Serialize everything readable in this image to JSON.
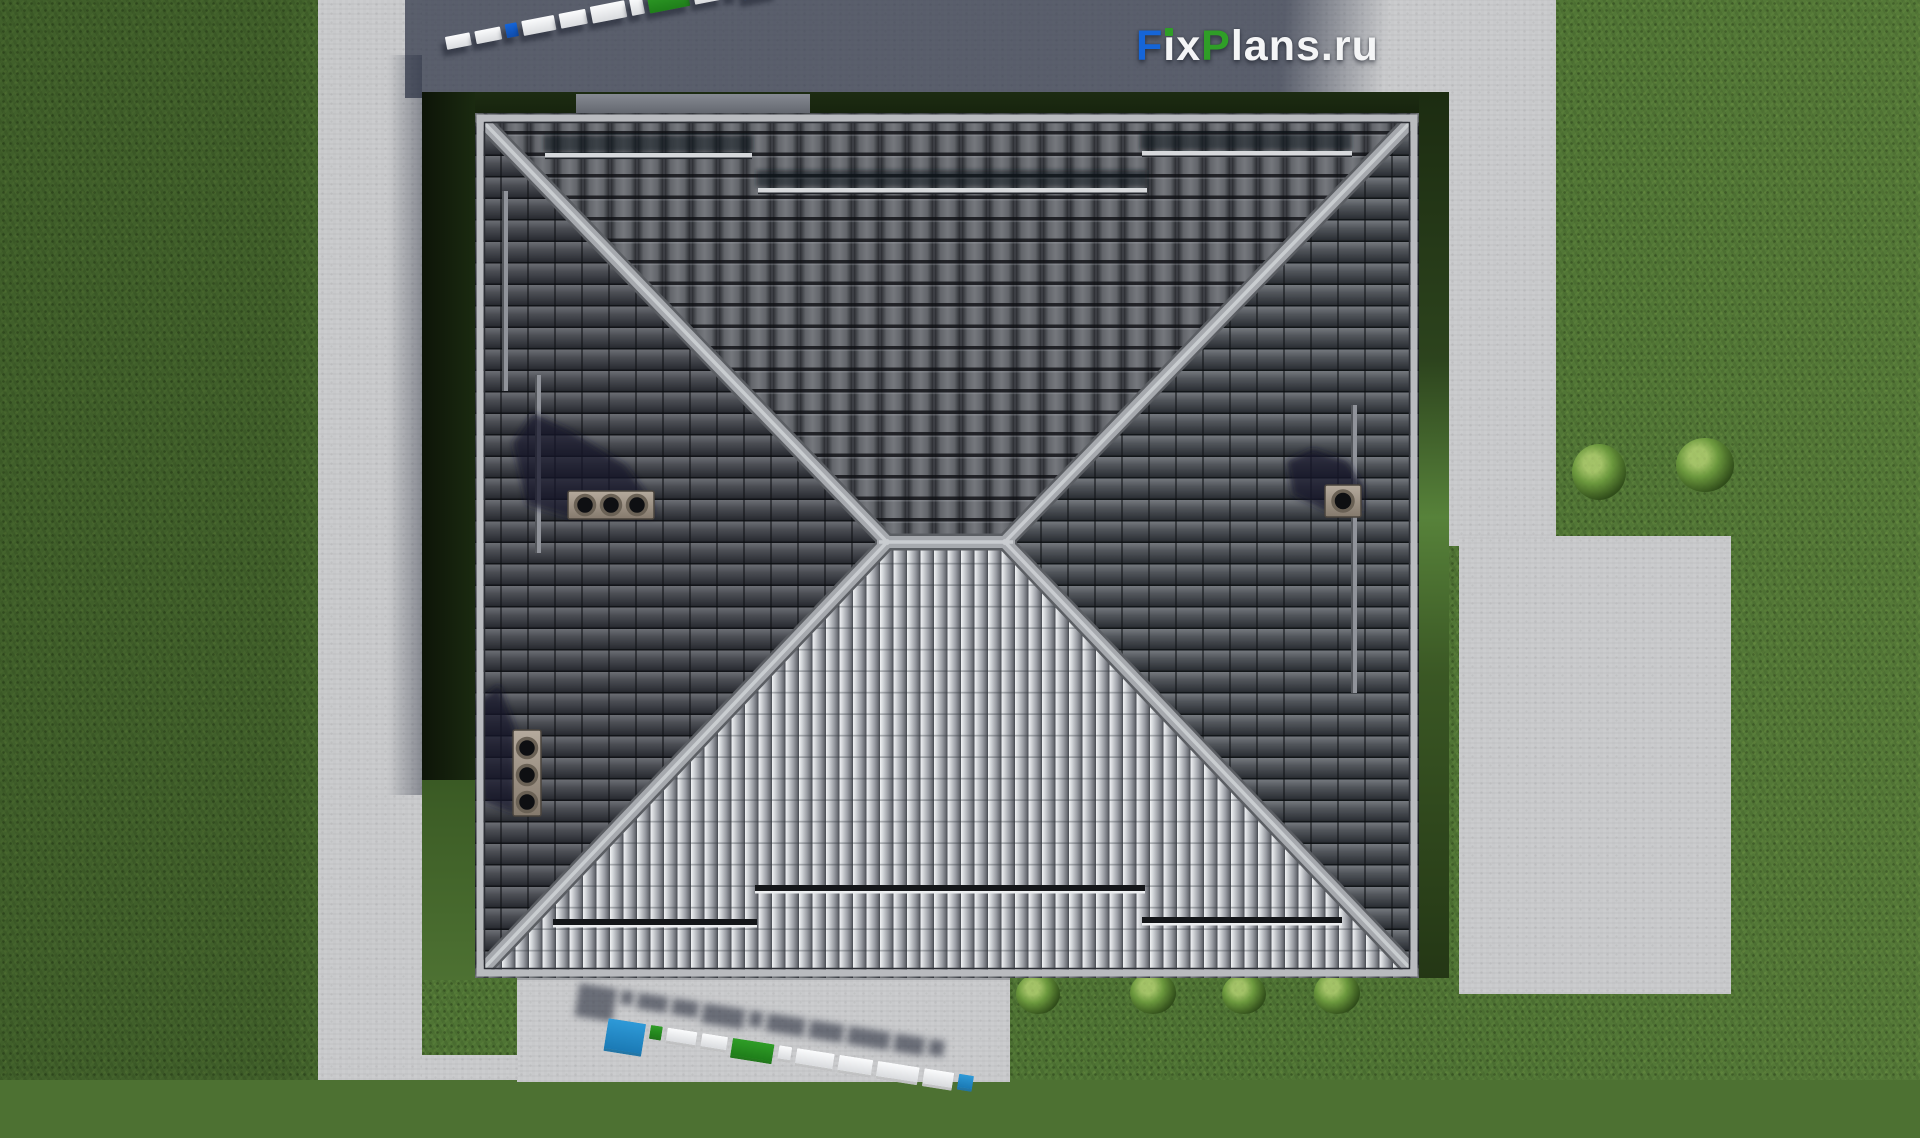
{
  "brand": {
    "logo_text": "FixPlans.ru",
    "logo_segments": {
      "f": "F",
      "ix": "ix",
      "p": "P",
      "rest": "lans.ru"
    },
    "colors": {
      "blue": "#1565d8",
      "green": "#2f9e27",
      "white": "#f4f5f6",
      "sky": "#2e9ad8"
    }
  },
  "scene": {
    "type": "top-down 3d render of hipped roof house",
    "roof": {
      "tile_dark": "#55585f",
      "tile_bright": "#c3c5ca",
      "ridge": "#a6a9ae",
      "eave_trim": "#b9bbbf",
      "chimney_cap": "#a99d90",
      "chimney_count": 3,
      "snow_guard_count_top": 3,
      "snow_guard_count_bottom": 3
    },
    "ground": {
      "grass": "#4f7434",
      "concrete": "#c8c9cb",
      "driveway_in_shadow": "#5a6070",
      "hedge": "#1d2c12",
      "bush_count_right_lawn": 2,
      "bush_count_south_bed": 4
    }
  },
  "watermark_top": {
    "rotation_deg": -11,
    "blocks": [
      {
        "c": "white",
        "w": 30,
        "h": 13
      },
      {
        "c": "white",
        "w": 32,
        "h": 13
      },
      {
        "c": "blue",
        "w": 15,
        "h": 14
      },
      {
        "c": "white",
        "w": 40,
        "h": 15
      },
      {
        "c": "white",
        "w": 33,
        "h": 15
      },
      {
        "c": "white",
        "w": 44,
        "h": 17
      },
      {
        "c": "white",
        "w": 15,
        "h": 17
      },
      {
        "c": "green",
        "w": 50,
        "h": 20
      },
      {
        "c": "white",
        "w": 35,
        "h": 20
      },
      {
        "c": "green",
        "w": 13,
        "h": 20
      },
      {
        "c": "blue",
        "w": 42,
        "h": 30
      }
    ]
  },
  "watermark_bottom": {
    "rotation_deg": 9,
    "blocks": [
      {
        "c": "sky",
        "w": 38,
        "h": 30
      },
      {
        "c": "green",
        "w": 12,
        "h": 11
      },
      {
        "c": "white",
        "w": 30,
        "h": 13
      },
      {
        "c": "white",
        "w": 26,
        "h": 13
      },
      {
        "c": "green",
        "w": 42,
        "h": 17
      },
      {
        "c": "white",
        "w": 13,
        "h": 13
      },
      {
        "c": "white",
        "w": 38,
        "h": 15
      },
      {
        "c": "white",
        "w": 34,
        "h": 15
      },
      {
        "c": "white",
        "w": 42,
        "h": 15
      },
      {
        "c": "white",
        "w": 30,
        "h": 15
      },
      {
        "c": "sky",
        "w": 15,
        "h": 13
      }
    ]
  }
}
